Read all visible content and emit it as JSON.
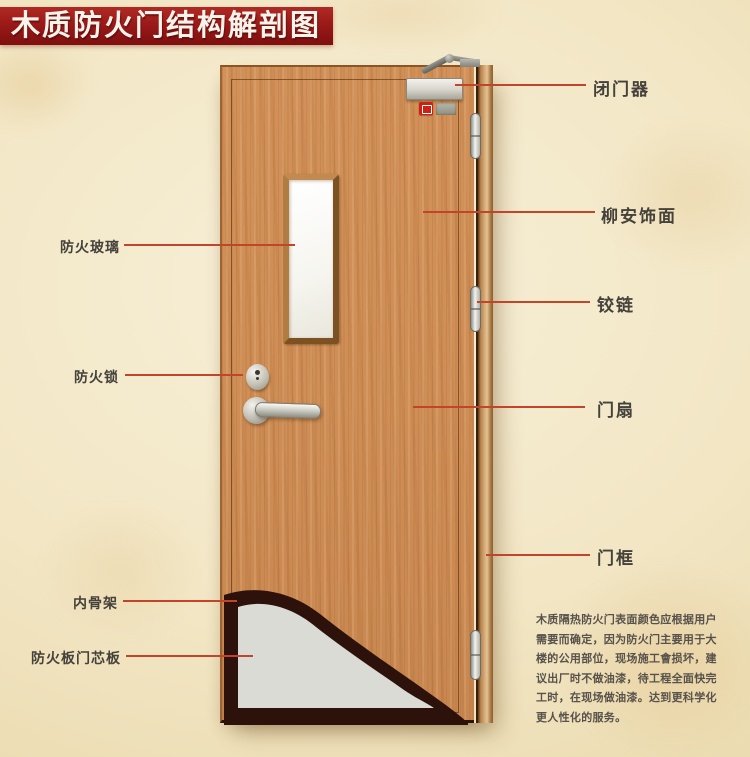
{
  "title": {
    "text": "木质防火门结构解剖图"
  },
  "labels": {
    "left": [
      {
        "text": "防火玻璃"
      },
      {
        "text": "防火锁"
      },
      {
        "text": "内骨架"
      },
      {
        "text": "防火板门芯板"
      }
    ],
    "right": [
      {
        "text": "闭门器"
      },
      {
        "text": "柳安饰面"
      },
      {
        "text": "铰链"
      },
      {
        "text": "门扇"
      },
      {
        "text": "门框"
      }
    ]
  },
  "description": {
    "lines": [
      "木质隔热防火门表面颜色应根据用户",
      "需要而确定，因为防火门主要用于大",
      "楼的公用部位，现场施工會损坏，建",
      "议出厂时不做油漆，待工程全面快完",
      "工时，在现场做油漆。达到更科学化",
      "更人性化的服务。"
    ]
  },
  "colors": {
    "banner_red": "#9a1a18",
    "leader_line": "#c2442a",
    "label_text": "#45413b",
    "door_wood": "#cf8e55",
    "frame_wood": "#b5834e",
    "skeleton_dark": "#2d120b",
    "core_board_gray": "#d9dbd4",
    "background_parchment": "#f2e6c4"
  }
}
